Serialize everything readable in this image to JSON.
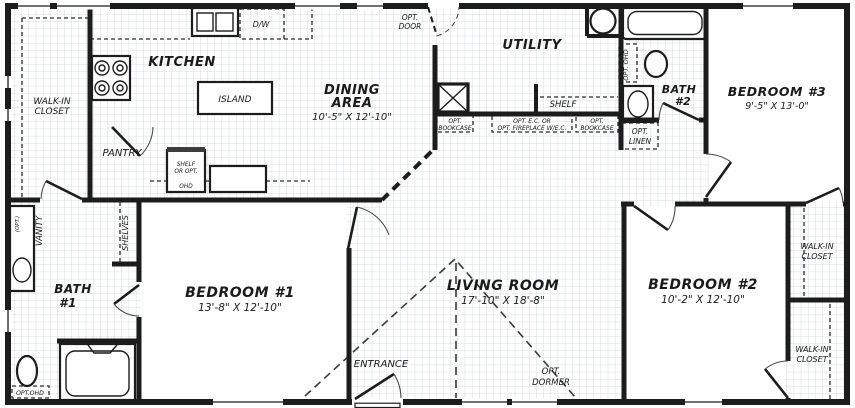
{
  "plan": {
    "rooms": {
      "kitchen": {
        "label": "KITCHEN"
      },
      "dining": {
        "line1": "DINING",
        "line2": "AREA",
        "dims": "10'-5\" X 12'-10\""
      },
      "utility": {
        "label": "UTILITY"
      },
      "living": {
        "label": "LIVING ROOM",
        "dims": "17'-10\" X 18'-8\""
      },
      "bedroom1": {
        "label": "BEDROOM #1",
        "dims": "13'-8\" X 12'-10\""
      },
      "bedroom2": {
        "label": "BEDROOM #2",
        "dims": "10'-2\" X 12'-10\""
      },
      "bedroom3": {
        "label": "BEDROOM #3",
        "dims": "9'-5\" X 13'-0\""
      },
      "bath1": {
        "line1": "BATH",
        "line2": "#1"
      },
      "bath2": {
        "line1": "BATH",
        "line2": "#2"
      },
      "closet_tl": {
        "line1": "WALK-IN",
        "line2": "CLOSET"
      },
      "closet_r_upper": {
        "line1": "WALK-IN",
        "line2": "CLOSET"
      },
      "closet_r_lower": {
        "line1": "WALK-IN",
        "line2": "CLOSET"
      },
      "pantry": {
        "label": "PANTRY"
      },
      "entrance": {
        "label": "ENTRANCE"
      }
    },
    "labels": {
      "opt_door_1": "OPT.",
      "opt_door_2": "DOOR",
      "opt_dormer_1": "OPT.",
      "opt_dormer_2": "DORMER",
      "shelf": "SHELF",
      "opt_bookcase_1": "OPT.",
      "opt_bookcase_2": "BOOKCASE",
      "opt_fireplace_1": "OPT. E.C. OR",
      "opt_fireplace_2": "OPT. FIREPLACE W/E.C.",
      "opt_linen_1": "OPT.",
      "opt_linen_2": "LINEN",
      "opt_ohd": "OPT. OHD",
      "opt_ohd_compact": "OPT.OHD",
      "vanity": "VANITY",
      "vanity_opt": "(OPT.)",
      "shelves": "SHELVES",
      "island": "ISLAND",
      "dw": "D/W",
      "shelf_ohd_1": "SHELF",
      "shelf_ohd_2": "OR OPT.",
      "shelf_ohd_3": "OHD"
    },
    "colors": {
      "wall": "#1c1c1c",
      "grid": "#ccd1d5",
      "background": "#ffffff",
      "text": "#1b1b1b"
    }
  }
}
